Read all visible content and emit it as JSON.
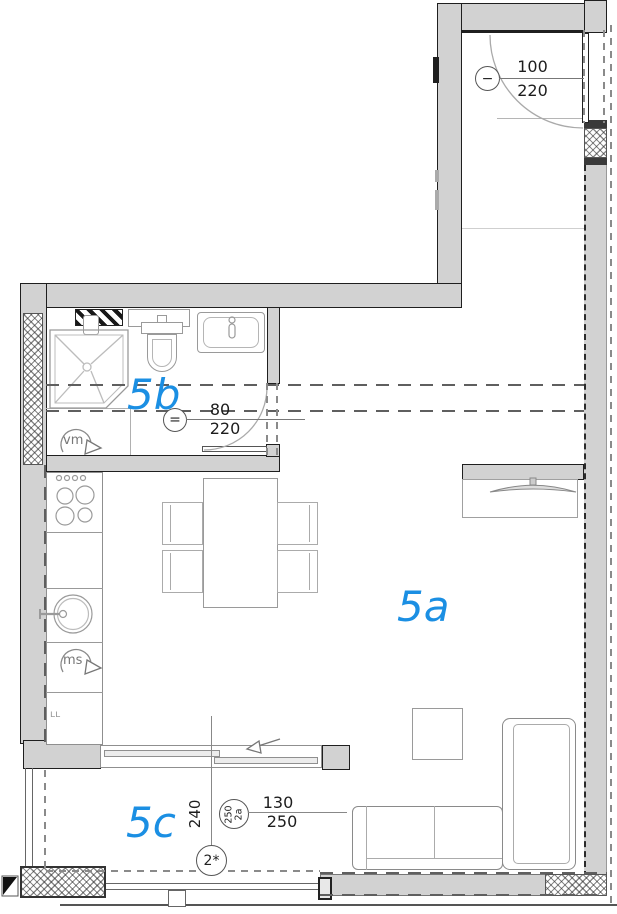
{
  "plan_title": "apartment floor plan",
  "colors": {
    "room_label": "#1b8fe3",
    "wall_fill": "#d2d2d2",
    "outline": "#1f1f1f"
  },
  "rooms": {
    "a": "5a",
    "b": "5b",
    "c": "5c"
  },
  "dims": {
    "entry": {
      "marker": "−",
      "top": "100",
      "bottom": "220"
    },
    "bath": {
      "marker": "=",
      "top": "80",
      "bottom": "220"
    },
    "balcony": {
      "width": "240",
      "circle_top": "250",
      "circle_bottom": "2a",
      "frac_top": "130",
      "frac_bottom": "250",
      "floor": "2*"
    }
  },
  "appliances": {
    "washing_machine": "vm",
    "dishwasher": "ms",
    "cabinet": "ʟʟ"
  }
}
